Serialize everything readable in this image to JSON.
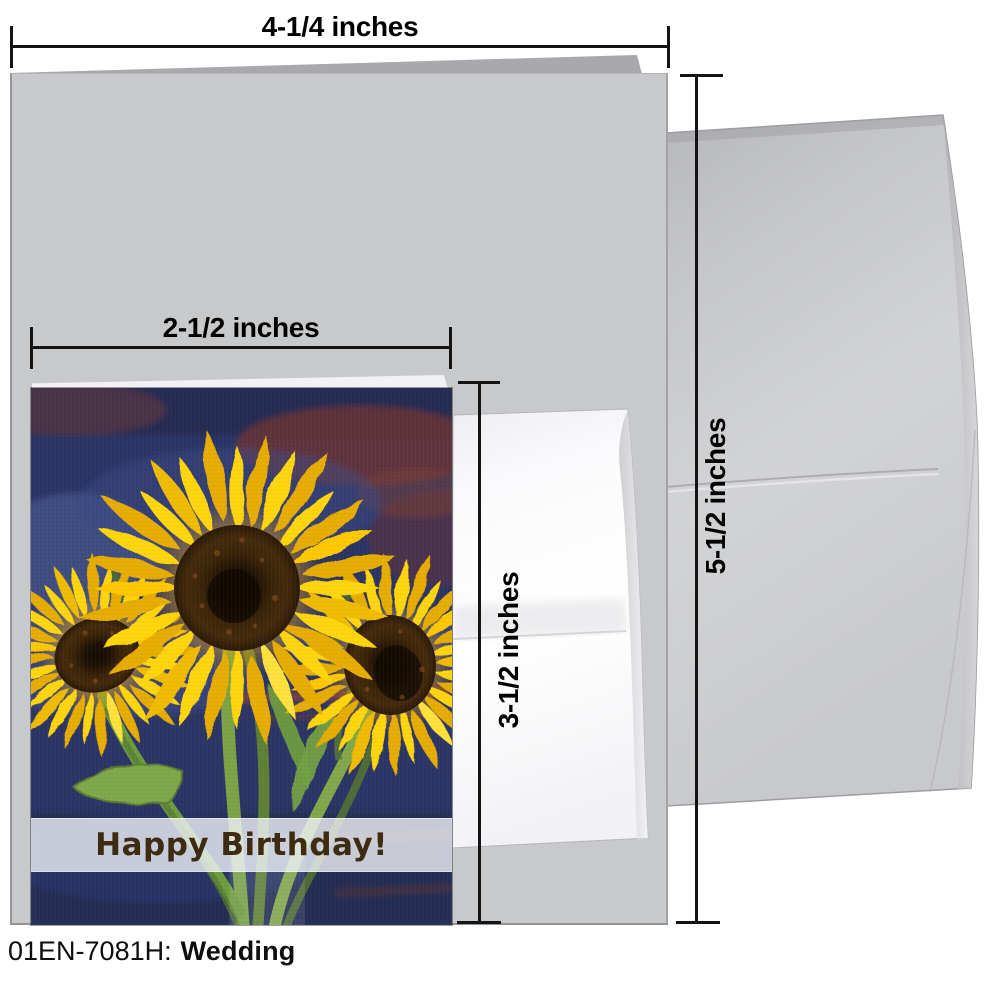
{
  "dimension_labels": {
    "large_width": "4-1/4 inches",
    "large_height": "5-1/2 inches",
    "small_width": "2-1/2 inches",
    "small_height": "3-1/2 inches"
  },
  "greeting": {
    "message": "Happy Birthday!",
    "text_color": "#3E2C12",
    "band_color": "rgba(240,242,248,0.8)"
  },
  "caption": {
    "sku": "01EN-7081H:",
    "category": "Wedding"
  },
  "colors": {
    "page_background": "#FFFFFF",
    "dimension_line": "#141414",
    "card_gray": "#C7C9CB",
    "card_back_gray": "#A8A8AD",
    "envelope_gray": "#CDCDD0",
    "small_envelope_white": "#FBFBFD",
    "painting_navy": "#2C3666",
    "painting_maroon": "#6E3636",
    "sunflower_yellow": "#FFD60E",
    "sunflower_center_brown": "#3A2409",
    "stem_green": "#6F9C3F"
  }
}
